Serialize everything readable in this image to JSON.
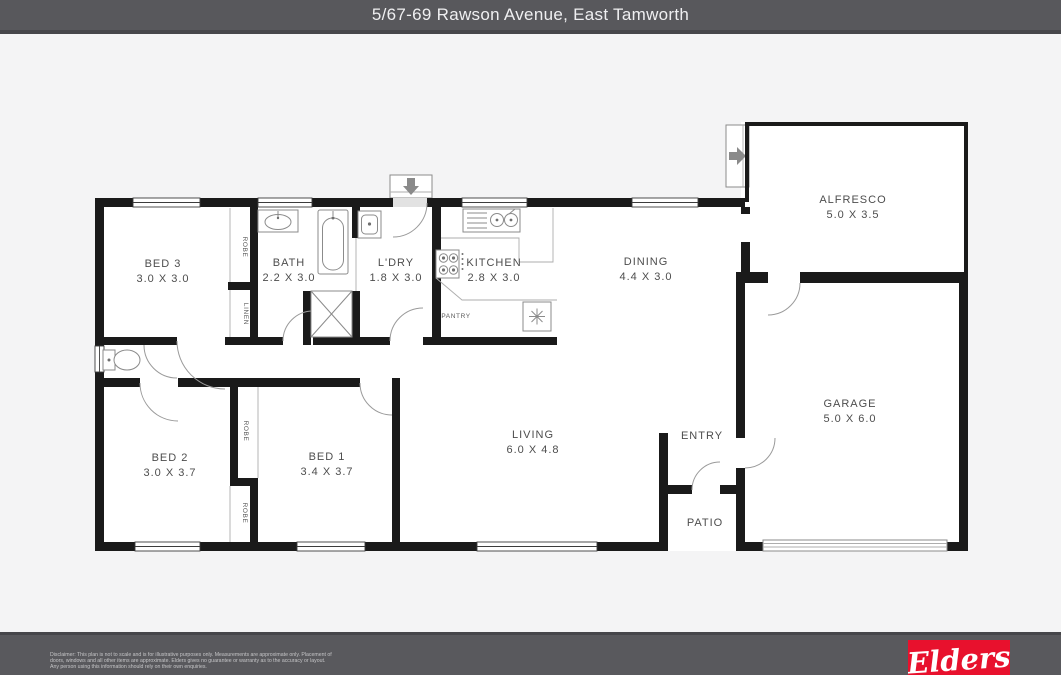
{
  "header": {
    "title": "5/67-69 Rawson Avenue, East Tamworth"
  },
  "rooms": [
    {
      "name": "BED 3",
      "dims": "3.0 X 3.0"
    },
    {
      "name": "BATH",
      "dims": "2.2 X 3.0"
    },
    {
      "name": "L'DRY",
      "dims": "1.8 X 3.0"
    },
    {
      "name": "KITCHEN",
      "dims": "2.8 X 3.0"
    },
    {
      "name": "DINING",
      "dims": "4.4 X 3.0"
    },
    {
      "name": "ALFRESCO",
      "dims": "5.0 X 3.5"
    },
    {
      "name": "GARAGE",
      "dims": "5.0 X 6.0"
    },
    {
      "name": "BED 2",
      "dims": "3.0 X 3.7"
    },
    {
      "name": "BED 1",
      "dims": "3.4 X 3.7"
    },
    {
      "name": "LIVING",
      "dims": "6.0 X 4.8"
    },
    {
      "name": "ENTRY",
      "dims": ""
    },
    {
      "name": "PATIO",
      "dims": ""
    }
  ],
  "closets": {
    "robe": "ROBE",
    "linen": "LINEN",
    "pantry": "PANTRY"
  },
  "footer": {
    "disclaimer_line1": "Disclaimer: This plan is not to scale and is for illustrative purposes only. Measurements are approximate only. Placement of",
    "disclaimer_line2": "doors, windows and all other items are approximate. Elders gives no guarantee or warranty as to the accuracy or layout.",
    "disclaimer_line3": "Any person using this information should rely on their own enquiries."
  },
  "logo": {
    "brand": "Elders",
    "color": "#e8112d"
  },
  "colors": {
    "header_bg": "#58585c",
    "wall": "#1a1a1a",
    "page_bg": "#f4f4f5",
    "logo_red": "#e8112d"
  }
}
